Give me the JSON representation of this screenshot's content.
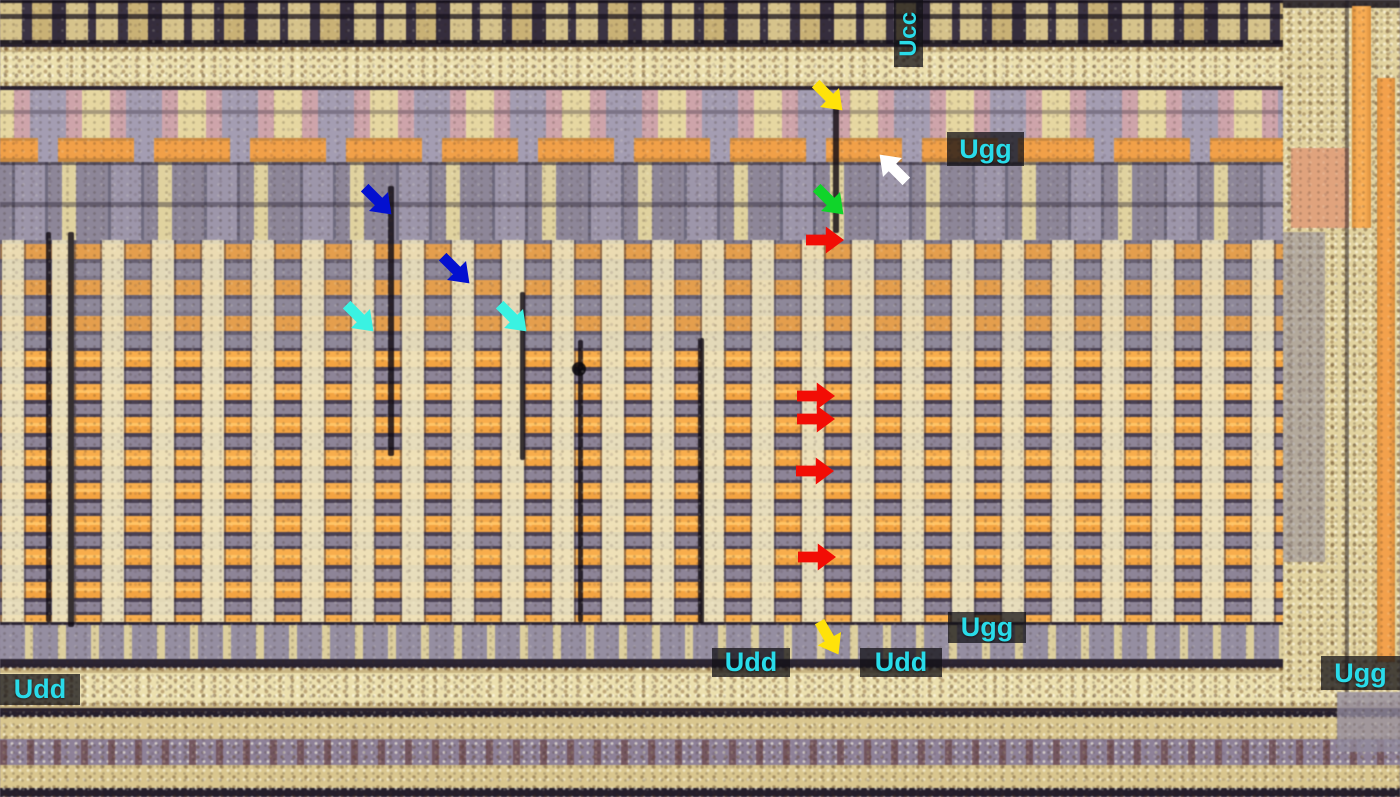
{
  "annotations": {
    "voltage_labels": [
      {
        "id": "ucc-top",
        "text": "Ucc",
        "x": 894,
        "y": 0,
        "w": 29,
        "h": 67,
        "orientation": "vertical"
      },
      {
        "id": "ugg-top",
        "text": "Ugg",
        "x": 947,
        "y": 132,
        "w": 77,
        "h": 34,
        "orientation": "horizontal"
      },
      {
        "id": "ugg-middle",
        "text": "Ugg",
        "x": 948,
        "y": 612,
        "w": 78,
        "h": 31,
        "orientation": "horizontal"
      },
      {
        "id": "udd-middle-left",
        "text": "Udd",
        "x": 712,
        "y": 648,
        "w": 78,
        "h": 29,
        "orientation": "horizontal"
      },
      {
        "id": "udd-middle-right",
        "text": "Udd",
        "x": 860,
        "y": 648,
        "w": 82,
        "h": 29,
        "orientation": "horizontal"
      },
      {
        "id": "udd-bottom-left",
        "text": "Udd",
        "x": 0,
        "y": 674,
        "w": 80,
        "h": 31,
        "orientation": "horizontal"
      },
      {
        "id": "ugg-bottom-right",
        "text": "Ugg",
        "x": 1321,
        "y": 656,
        "w": 79,
        "h": 34,
        "orientation": "horizontal"
      }
    ],
    "arrows": [
      {
        "color": "yellow",
        "hex": "#ffe20a",
        "cx": 829,
        "cy": 97,
        "direction": "down-right",
        "rotation": 45
      },
      {
        "color": "white",
        "hex": "#ffffff",
        "cx": 893,
        "cy": 168,
        "direction": "up-left",
        "rotation": 225
      },
      {
        "color": "green",
        "hex": "#10d42a",
        "cx": 830,
        "cy": 201,
        "direction": "down-right",
        "rotation": 45
      },
      {
        "color": "red",
        "hex": "#f20d05",
        "cx": 825,
        "cy": 240,
        "direction": "right",
        "rotation": 0
      },
      {
        "color": "blue",
        "hex": "#0310d0",
        "cx": 378,
        "cy": 201,
        "direction": "down-right",
        "rotation": 45
      },
      {
        "color": "blue",
        "hex": "#0310d0",
        "cx": 456,
        "cy": 270,
        "direction": "down-right",
        "rotation": 45
      },
      {
        "color": "cyan",
        "hex": "#3af2e2",
        "cx": 360,
        "cy": 318,
        "direction": "down-right",
        "rotation": 45
      },
      {
        "color": "cyan",
        "hex": "#3af2e2",
        "cx": 513,
        "cy": 318,
        "direction": "down-right",
        "rotation": 45
      },
      {
        "color": "red",
        "hex": "#f20d05",
        "cx": 816,
        "cy": 396,
        "direction": "right",
        "rotation": 0
      },
      {
        "color": "red",
        "hex": "#f20d05",
        "cx": 816,
        "cy": 419,
        "direction": "right",
        "rotation": 0
      },
      {
        "color": "red",
        "hex": "#f20d05",
        "cx": 815,
        "cy": 471,
        "direction": "right",
        "rotation": 0
      },
      {
        "color": "red",
        "hex": "#f20d05",
        "cx": 817,
        "cy": 557,
        "direction": "right",
        "rotation": 0
      },
      {
        "color": "yellow",
        "hex": "#ffe20a",
        "cx": 829,
        "cy": 638,
        "direction": "down-right",
        "rotation": 60
      }
    ],
    "label_style": {
      "text_color": "#29dbe9",
      "background": "rgba(17,16,22,0.74)"
    }
  },
  "palette": {
    "metal_orange": "#f2a343",
    "silicide_gold": "#e9dcab",
    "poly_gray": "#948da0",
    "dark_gap": "#2b2430",
    "salmon": "#d8a29c"
  }
}
